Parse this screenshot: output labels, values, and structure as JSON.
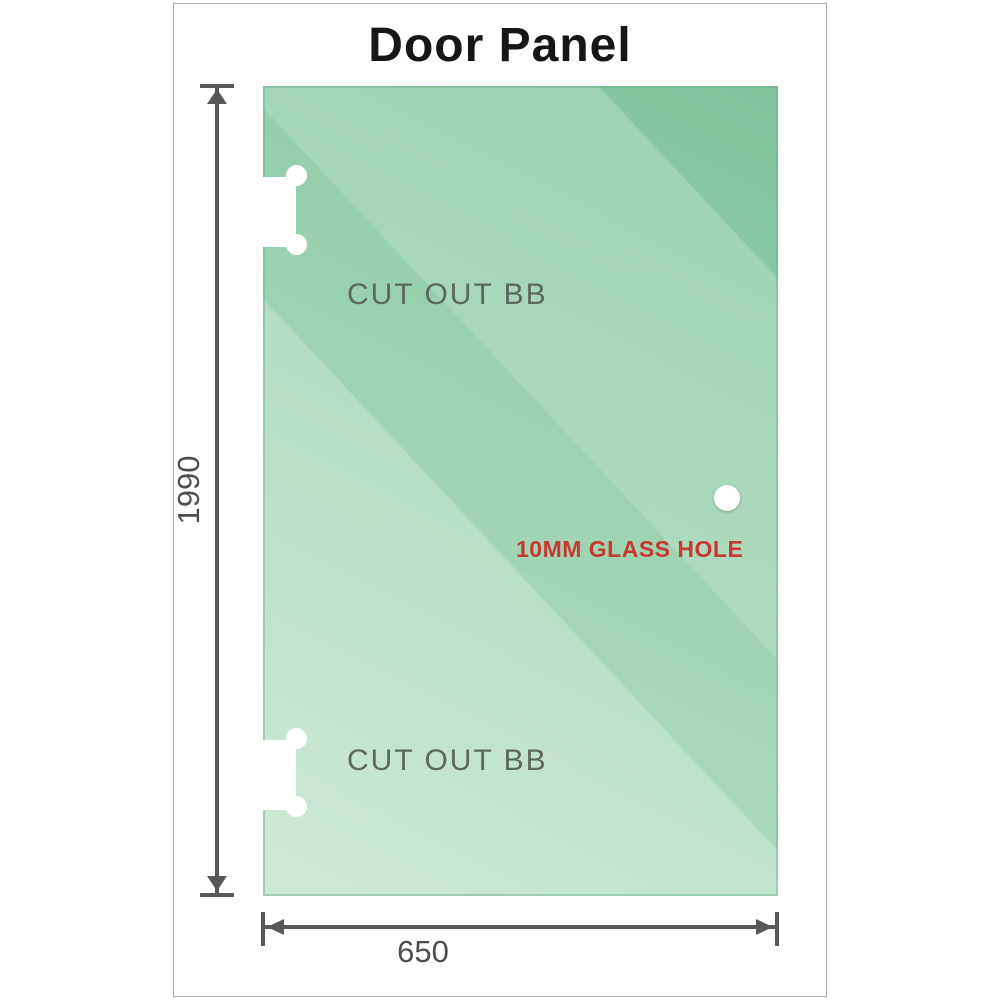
{
  "title": "Door Panel",
  "panel": {
    "cutout_top_label": "CUT OUT BB",
    "cutout_bottom_label": "CUT OUT BB",
    "hole_label": "10MM GLASS HOLE"
  },
  "dimensions": {
    "height_label": "1990",
    "width_label": "650"
  },
  "colors": {
    "glass_base": "#85c7a0",
    "glass_light": "#cfead8",
    "dimension_gray": "#57585a",
    "number_gray": "#4d4e50",
    "label_gray": "#5d6861",
    "hole_label_red": "#c63a31",
    "title_black": "#161616",
    "frame_border": "#a9abae"
  }
}
